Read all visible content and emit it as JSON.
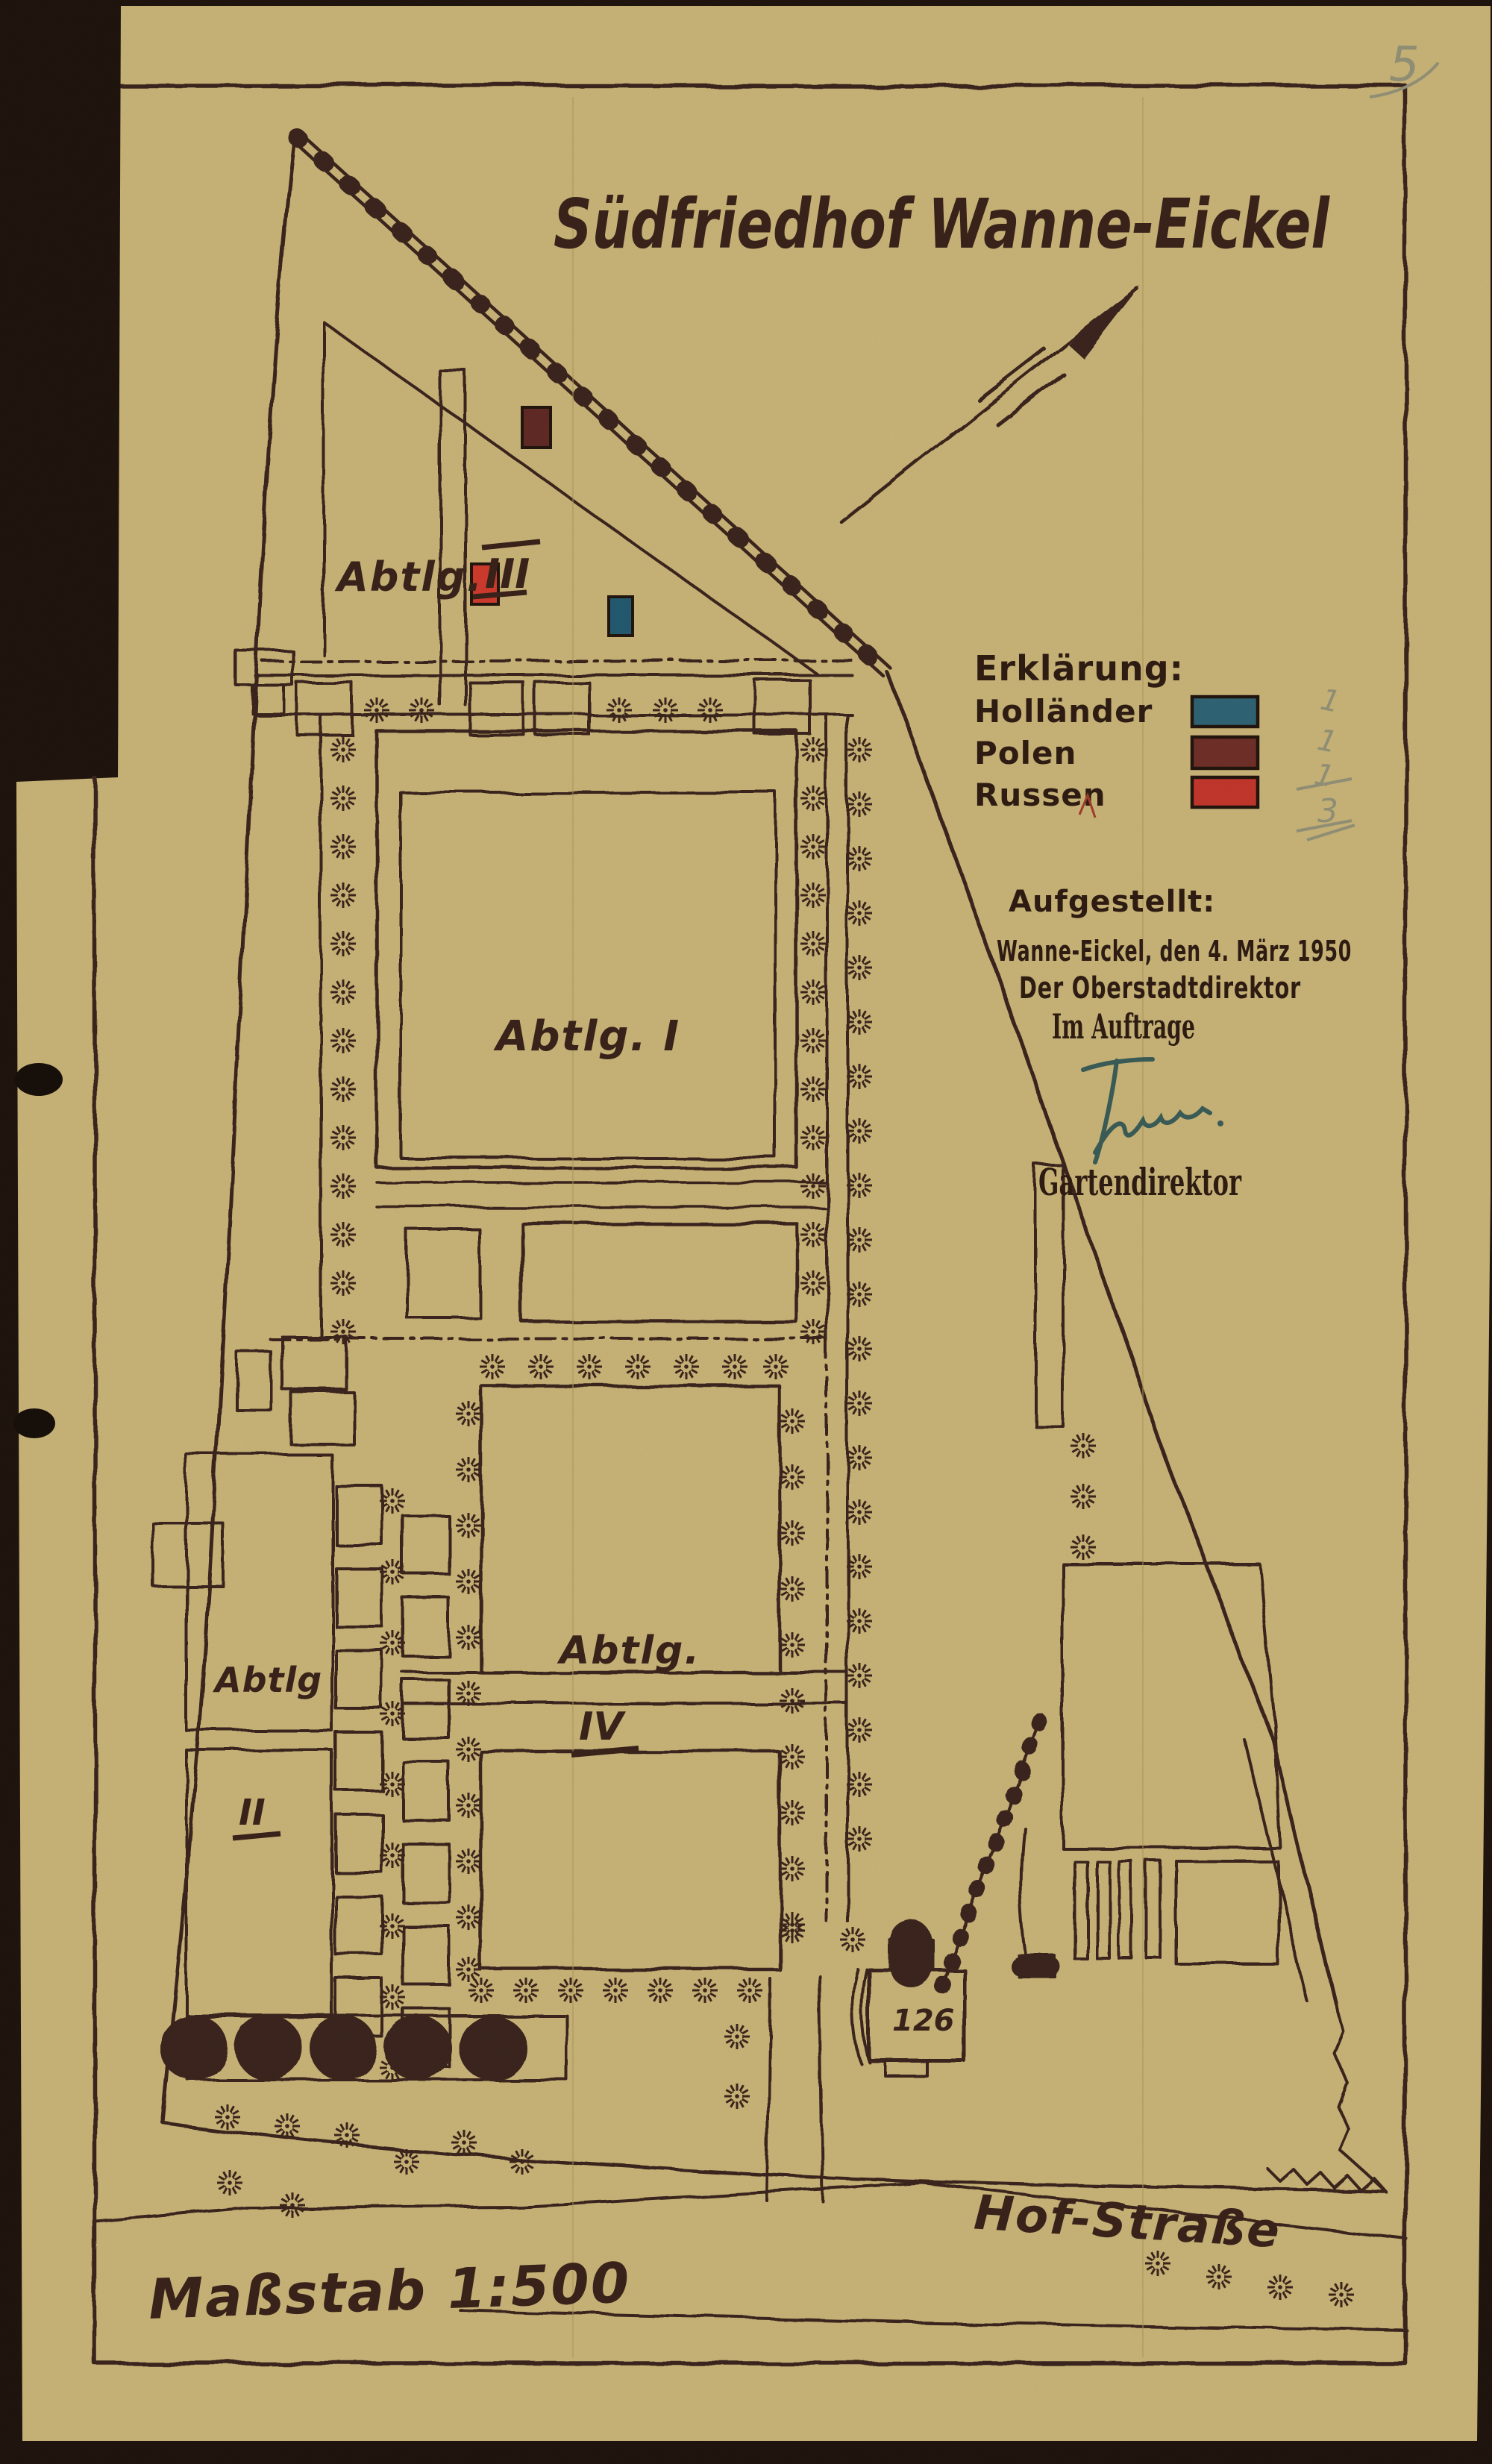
{
  "page": {
    "number": "5"
  },
  "title": "Südfriedhof Wanne-Eickel",
  "map": {
    "scale_label": "Maßstab 1:500",
    "street_label": "Hof-Straße",
    "building_number": "126",
    "sections": {
      "three": {
        "prefix": "Abtlg.",
        "numeral": "III"
      },
      "one": {
        "label": "Abtlg. I"
      },
      "four": {
        "prefix": "Abtlg.",
        "numeral": "IV"
      },
      "two": {
        "prefix": "Abtlg",
        "numeral": "II"
      }
    },
    "markers": {
      "hollaender": "#20586f",
      "polen": "#5e2723",
      "russen": "#cd392b"
    }
  },
  "legend": {
    "title": "Erklärung:",
    "entries": [
      {
        "label": "Holländer",
        "color": "#2c6173",
        "count": "1"
      },
      {
        "label": "Polen",
        "color": "#6d2d27",
        "count": "1"
      },
      {
        "label": "Russen",
        "color": "#c1352a",
        "count": "1"
      }
    ],
    "total": "3"
  },
  "attribution": {
    "label": "Aufgestellt:",
    "place_date": "Wanne-Eickel, den 4. März 1950",
    "office": "Der Oberstadtdirektor",
    "by_order": "Im Auftrage",
    "signer_title": "Gartendirektor"
  },
  "colors": {
    "paper": "#c7b377",
    "backdrop": "#1c120c",
    "ink": "#38221a",
    "pencil": "#8f8d74"
  }
}
